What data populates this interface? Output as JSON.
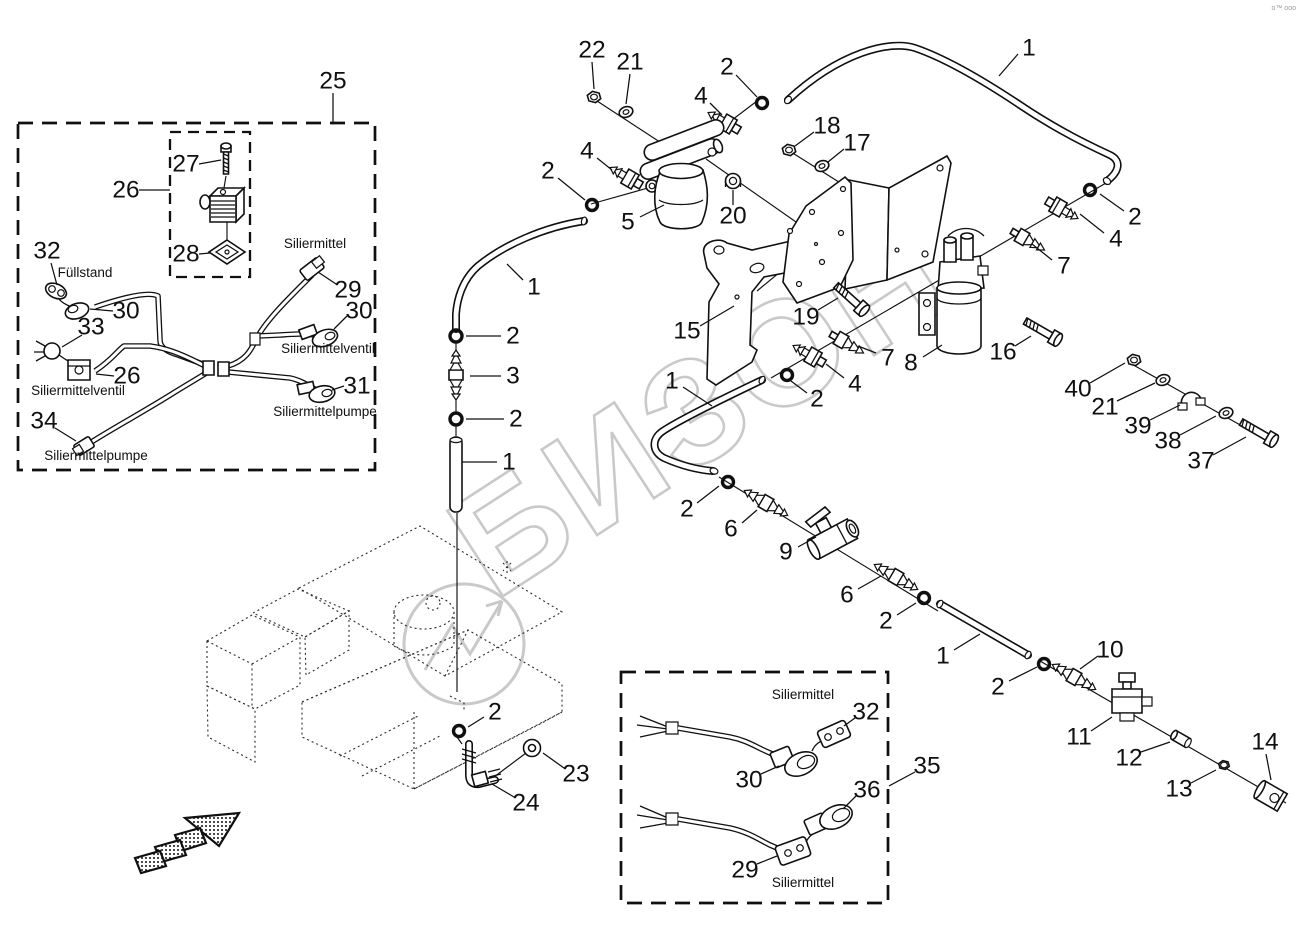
{
  "meta": {
    "watermark_text": "БИЗОН",
    "watermark_color": "#c9c9c9",
    "corner_mark": "o™ ooo",
    "background": "#ffffff",
    "line_color": "#101010"
  },
  "captions": [
    {
      "text": "Füllstand",
      "x": 85,
      "y": 277
    },
    {
      "text": "Siliermittelventil",
      "x": 78,
      "y": 395
    },
    {
      "text": "Siliermittelpumpe",
      "x": 96,
      "y": 460
    },
    {
      "text": "Siliermittel",
      "x": 315,
      "y": 248
    },
    {
      "text": "Siliermittelventil",
      "x": 328,
      "y": 353
    },
    {
      "text": "Siliermittelpumpe",
      "x": 325,
      "y": 416
    },
    {
      "text": "Siliermittel",
      "x": 803,
      "y": 699
    },
    {
      "text": "Siliermittel",
      "x": 803,
      "y": 887
    }
  ],
  "callouts": [
    {
      "n": "25",
      "x": 333,
      "y": 81,
      "leader": [
        333,
        93,
        333,
        123
      ]
    },
    {
      "n": "27",
      "x": 186,
      "y": 164,
      "leader": [
        199,
        164,
        221,
        160
      ]
    },
    {
      "n": "26",
      "x": 126,
      "y": 190,
      "leader": [
        139,
        190,
        170,
        190
      ]
    },
    {
      "n": "28",
      "x": 186,
      "y": 254,
      "leader": [
        199,
        254,
        210,
        253
      ]
    },
    {
      "n": "32",
      "x": 47,
      "y": 251,
      "leader": [
        51,
        263,
        57,
        285
      ]
    },
    {
      "n": "30",
      "x": 126,
      "y": 311,
      "leader": [
        113,
        311,
        90,
        309
      ]
    },
    {
      "n": "33",
      "x": 91,
      "y": 327,
      "leader": [
        82,
        335,
        62,
        347
      ]
    },
    {
      "n": "26",
      "x": 127,
      "y": 376,
      "leader": [
        114,
        376,
        96,
        374
      ]
    },
    {
      "n": "34",
      "x": 44,
      "y": 421,
      "leader": [
        55,
        428,
        76,
        441
      ]
    },
    {
      "n": "29",
      "x": 348,
      "y": 290,
      "leader": [
        336,
        284,
        318,
        272
      ]
    },
    {
      "n": "30",
      "x": 359,
      "y": 311,
      "leader": [
        347,
        316,
        334,
        329
      ]
    },
    {
      "n": "31",
      "x": 357,
      "y": 386,
      "leader": [
        344,
        386,
        332,
        390
      ]
    },
    {
      "n": "22",
      "x": 592,
      "y": 50,
      "leader": [
        592,
        62,
        594,
        89
      ]
    },
    {
      "n": "21",
      "x": 630,
      "y": 62,
      "leader": [
        630,
        74,
        626,
        104
      ]
    },
    {
      "n": "2",
      "x": 727,
      "y": 67,
      "leader": [
        736,
        75,
        757,
        97
      ]
    },
    {
      "n": "4",
      "x": 701,
      "y": 96,
      "leader": [
        710,
        103,
        722,
        115
      ]
    },
    {
      "n": "1",
      "x": 1029,
      "y": 48,
      "leader": [
        1018,
        54,
        999,
        76
      ]
    },
    {
      "n": "18",
      "x": 827,
      "y": 126,
      "leader": [
        814,
        132,
        795,
        146
      ]
    },
    {
      "n": "17",
      "x": 857,
      "y": 143,
      "leader": [
        844,
        149,
        828,
        162
      ]
    },
    {
      "n": "2",
      "x": 548,
      "y": 171,
      "leader": [
        558,
        178,
        585,
        200
      ]
    },
    {
      "n": "4",
      "x": 587,
      "y": 151,
      "leader": [
        597,
        158,
        612,
        170
      ]
    },
    {
      "n": "5",
      "x": 628,
      "y": 222,
      "leader": [
        640,
        217,
        664,
        205
      ]
    },
    {
      "n": "20",
      "x": 733,
      "y": 216,
      "leader": [
        733,
        205,
        733,
        190
      ]
    },
    {
      "n": "1",
      "x": 534,
      "y": 287,
      "leader": [
        523,
        280,
        507,
        264
      ]
    },
    {
      "n": "15",
      "x": 687,
      "y": 331,
      "leader": [
        700,
        326,
        734,
        306
      ]
    },
    {
      "n": "19",
      "x": 806,
      "y": 317,
      "leader": [
        818,
        310,
        838,
        298
      ]
    },
    {
      "n": "7",
      "x": 888,
      "y": 358,
      "leader": [
        876,
        353,
        858,
        346
      ]
    },
    {
      "n": "8",
      "x": 911,
      "y": 363,
      "leader": [
        923,
        357,
        942,
        345
      ]
    },
    {
      "n": "16",
      "x": 1003,
      "y": 352,
      "leader": [
        1015,
        346,
        1031,
        336
      ]
    },
    {
      "n": "2",
      "x": 817,
      "y": 399,
      "leader": [
        807,
        393,
        791,
        381
      ]
    },
    {
      "n": "4",
      "x": 855,
      "y": 384,
      "leader": [
        844,
        378,
        826,
        364
      ]
    },
    {
      "n": "7",
      "x": 1064,
      "y": 266,
      "leader": [
        1052,
        260,
        1032,
        244
      ]
    },
    {
      "n": "4",
      "x": 1116,
      "y": 239,
      "leader": [
        1104,
        233,
        1080,
        214
      ]
    },
    {
      "n": "2",
      "x": 1135,
      "y": 217,
      "leader": [
        1124,
        211,
        1100,
        194
      ]
    },
    {
      "n": "40",
      "x": 1078,
      "y": 389,
      "leader": [
        1090,
        383,
        1125,
        363
      ]
    },
    {
      "n": "21",
      "x": 1105,
      "y": 407,
      "leader": [
        1117,
        401,
        1155,
        383
      ]
    },
    {
      "n": "39",
      "x": 1138,
      "y": 426,
      "leader": [
        1150,
        420,
        1180,
        405
      ]
    },
    {
      "n": "38",
      "x": 1168,
      "y": 441,
      "leader": [
        1180,
        435,
        1216,
        416
      ]
    },
    {
      "n": "37",
      "x": 1201,
      "y": 461,
      "leader": [
        1213,
        455,
        1246,
        437
      ]
    },
    {
      "n": "2",
      "x": 513,
      "y": 336,
      "leader": [
        501,
        336,
        466,
        336
      ]
    },
    {
      "n": "3",
      "x": 513,
      "y": 376,
      "leader": [
        501,
        376,
        470,
        376
      ]
    },
    {
      "n": "2",
      "x": 516,
      "y": 419,
      "leader": [
        504,
        419,
        466,
        419
      ]
    },
    {
      "n": "1",
      "x": 509,
      "y": 462,
      "leader": [
        497,
        462,
        462,
        462
      ]
    },
    {
      "n": "1",
      "x": 672,
      "y": 381,
      "leader": [
        683,
        387,
        712,
        406
      ]
    },
    {
      "n": "2",
      "x": 687,
      "y": 509,
      "leader": [
        697,
        503,
        719,
        486
      ]
    },
    {
      "n": "6",
      "x": 731,
      "y": 529,
      "leader": [
        742,
        523,
        757,
        510
      ]
    },
    {
      "n": "9",
      "x": 786,
      "y": 552,
      "leader": [
        798,
        547,
        816,
        537
      ]
    },
    {
      "n": "6",
      "x": 847,
      "y": 595,
      "leader": [
        858,
        589,
        881,
        576
      ]
    },
    {
      "n": "2",
      "x": 886,
      "y": 621,
      "leader": [
        897,
        615,
        916,
        603
      ]
    },
    {
      "n": "1",
      "x": 943,
      "y": 656,
      "leader": [
        954,
        650,
        980,
        634
      ]
    },
    {
      "n": "2",
      "x": 998,
      "y": 687,
      "leader": [
        1009,
        681,
        1037,
        667
      ]
    },
    {
      "n": "10",
      "x": 1110,
      "y": 650,
      "leader": [
        1098,
        656,
        1080,
        669
      ]
    },
    {
      "n": "11",
      "x": 1079,
      "y": 737,
      "leader": [
        1091,
        731,
        1112,
        717
      ]
    },
    {
      "n": "12",
      "x": 1129,
      "y": 758,
      "leader": [
        1141,
        752,
        1170,
        742
      ]
    },
    {
      "n": "13",
      "x": 1179,
      "y": 789,
      "leader": [
        1191,
        783,
        1216,
        770
      ]
    },
    {
      "n": "14",
      "x": 1265,
      "y": 742,
      "leader": [
        1266,
        754,
        1271,
        780
      ]
    },
    {
      "n": "2",
      "x": 495,
      "y": 712,
      "leader": [
        484,
        717,
        468,
        727
      ]
    },
    {
      "n": "23",
      "x": 576,
      "y": 774,
      "leader": [
        564,
        768,
        543,
        753
      ]
    },
    {
      "n": "24",
      "x": 526,
      "y": 803,
      "leader": [
        514,
        797,
        492,
        784
      ]
    },
    {
      "n": "32",
      "x": 866,
      "y": 712,
      "leader": [
        855,
        718,
        844,
        726
      ]
    },
    {
      "n": "30",
      "x": 749,
      "y": 780,
      "leader": [
        761,
        774,
        779,
        766
      ]
    },
    {
      "n": "35",
      "x": 927,
      "y": 766,
      "leader": [
        915,
        772,
        889,
        786
      ]
    },
    {
      "n": "36",
      "x": 867,
      "y": 790,
      "leader": [
        856,
        796,
        843,
        809
      ]
    },
    {
      "n": "29",
      "x": 745,
      "y": 870,
      "leader": [
        757,
        864,
        777,
        856
      ]
    }
  ]
}
